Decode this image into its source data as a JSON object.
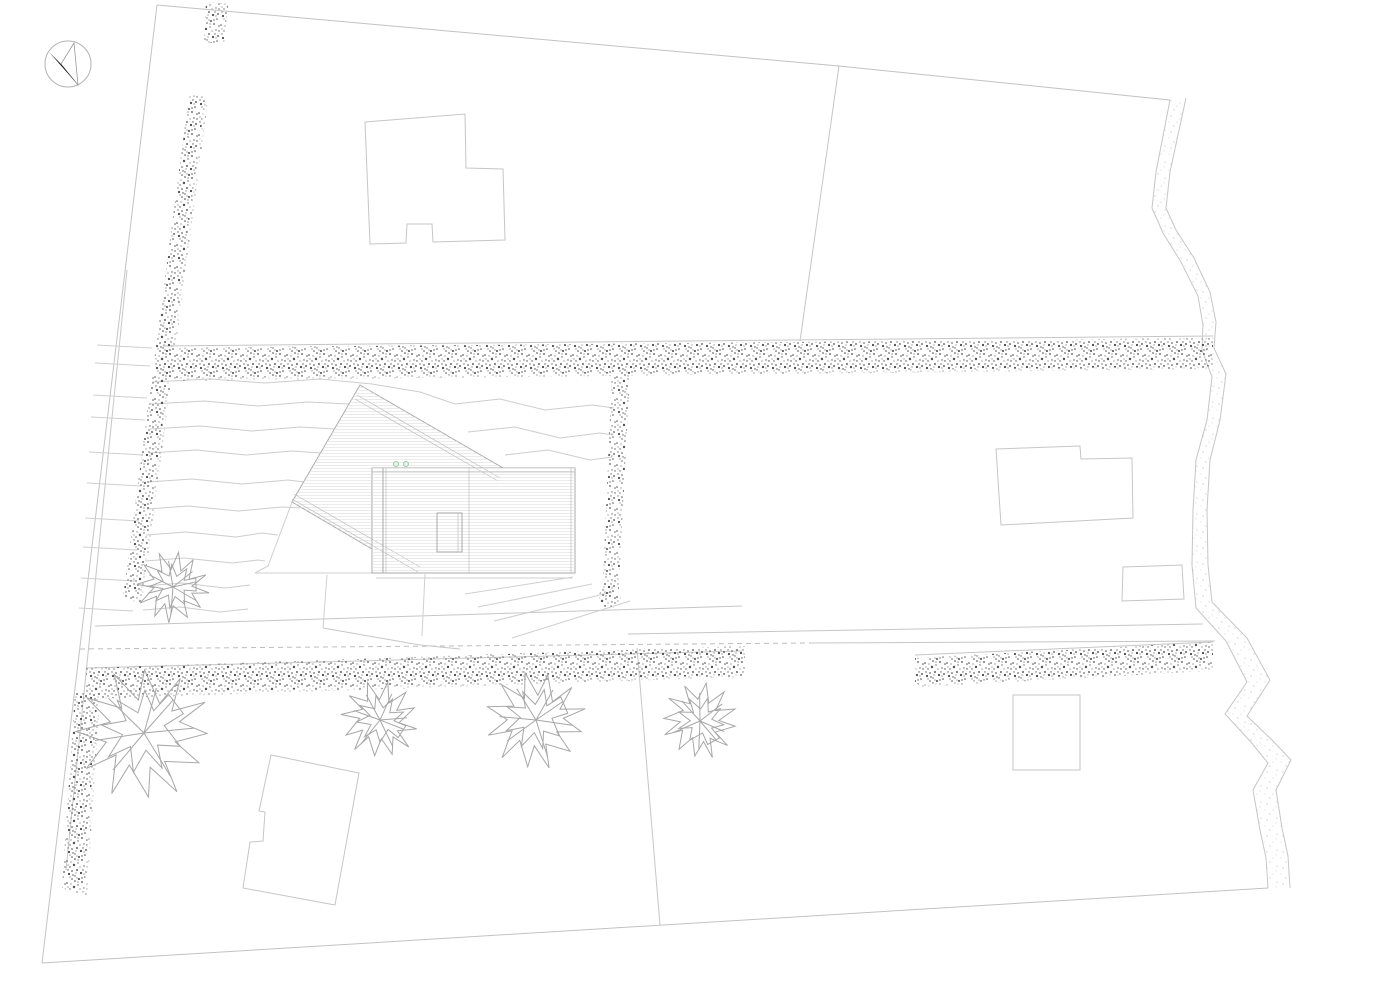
{
  "meta": {
    "type": "architectural-site-plan",
    "description": "Monochrome line-drawn site plan: an irregular group of parcels bounded by hedgerows, a stream along the east edge, a track crossing east-west, a main house with two roof volumes on a terraced garden plot, four neighbouring building footprints, five deciduous trees and a north arrow.",
    "visible_text": []
  },
  "colors": {
    "paper": "#ffffff",
    "boundary_line": "#c2c2c2",
    "parcel_line": "#c6c6c6",
    "contour_line": "#cdcdcd",
    "building_outline": "#c6c6c6",
    "house_outline": "#a6a6a6",
    "house_body_fill": "#ededed",
    "house_roof_fill": "#e9eae8",
    "skylight_fill": "#ffffff",
    "hedge_speckle": "#565656",
    "stream_speckle": "#dadada",
    "tree_stroke": "#a7a7a7",
    "marker_green_stroke": "#9cc7a8",
    "marker_green_fill": "#e7f3ec",
    "north_arrow_black": "#141414",
    "north_arrow_ring": "#b3b3b3"
  },
  "features": {
    "north_arrow": "compass needle, black half pointing north-west quadrant",
    "main_house": "grey roof-plan with rotated barn volume, flat volume, white skylight and 2 green roof markers",
    "neighbour_buildings_count": 4,
    "trees_count": 5,
    "hedgerows_count": 7,
    "stream": "speckled meandering band along east boundary",
    "track": "two long converging lines crossing the site east-west, partly dashed",
    "garden": "terraced slope west and south of house with stepped bank along west boundary"
  }
}
